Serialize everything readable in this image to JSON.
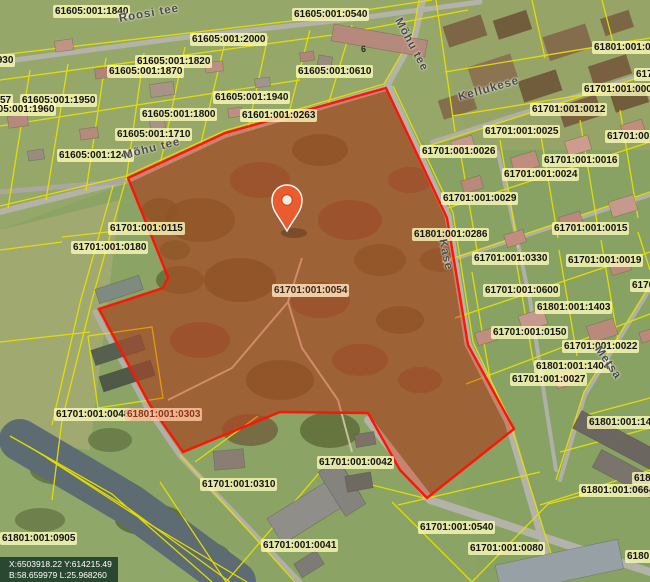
{
  "map": {
    "selected_parcel_code": "61701:001:0054",
    "building_number": "6",
    "coordinates_box": {
      "line1": "X:6503918.22 Y:614215.49",
      "line2": "B:58.659979 L:25.968260"
    },
    "colors": {
      "cadastral_line": "#e6e000",
      "parcel_outline": "#ff1405",
      "parcel_fill": "rgba(228,60,25,0.40)",
      "pin": "#ea5b2d",
      "label_bg": "rgba(255,252,185,0.78)"
    },
    "parcel_labels": [
      {
        "text": "61605:001:1840",
        "x": 53,
        "y": 5
      },
      {
        "text": "61605:001:0540",
        "x": 292,
        "y": 8
      },
      {
        "text": "61605:001:1930",
        "x": -62,
        "y": 54
      },
      {
        "text": "61605:001:2000",
        "x": 190,
        "y": 33
      },
      {
        "text": "61605:001:1820",
        "x": 135,
        "y": 55
      },
      {
        "text": "61605:001:1870",
        "x": 107,
        "y": 65
      },
      {
        "text": "61605:001:0610",
        "x": 296,
        "y": 65
      },
      {
        "text": "57",
        "x": -2,
        "y": 94
      },
      {
        "text": "61605:001:1950",
        "x": 20,
        "y": 94
      },
      {
        "text": "61605:001:1960",
        "x": -21,
        "y": 103
      },
      {
        "text": "61605:001:1800",
        "x": 140,
        "y": 108
      },
      {
        "text": "61605:001:1940",
        "x": 213,
        "y": 91
      },
      {
        "text": "61601:001:0263",
        "x": 240,
        "y": 109
      },
      {
        "text": "61605:001:1710",
        "x": 115,
        "y": 128
      },
      {
        "text": "61605:001:1240",
        "x": 57,
        "y": 149
      },
      {
        "text": "61701:001:0115",
        "x": 108,
        "y": 222
      },
      {
        "text": "61701:001:0180",
        "x": 71,
        "y": 241
      },
      {
        "text": "61701:001:0054",
        "x": 272,
        "y": 284,
        "variant": "highlight"
      },
      {
        "text": "61701:001:0048",
        "x": 54,
        "y": 408
      },
      {
        "text": "61801:001:0303",
        "x": 125,
        "y": 408,
        "variant": "redtext"
      },
      {
        "text": "61701:001:0310",
        "x": 200,
        "y": 478
      },
      {
        "text": "61701:001:0042",
        "x": 317,
        "y": 456
      },
      {
        "text": "61701:001:0041",
        "x": 261,
        "y": 539
      },
      {
        "text": "61801:001:0905",
        "x": 0,
        "y": 532
      },
      {
        "text": "61701:001:0540",
        "x": 418,
        "y": 521
      },
      {
        "text": "61701:001:0080",
        "x": 468,
        "y": 542
      },
      {
        "text": "61801:001:0664",
        "x": 579,
        "y": 484
      },
      {
        "text": "6180",
        "x": 632,
        "y": 472
      },
      {
        "text": "61801:001:142",
        "x": 587,
        "y": 416
      },
      {
        "text": "6180",
        "x": 625,
        "y": 550
      },
      {
        "text": "61701:001:",
        "x": 605,
        "y": 130
      },
      {
        "text": "61701:001:0025",
        "x": 483,
        "y": 125
      },
      {
        "text": "61701:001:0012",
        "x": 530,
        "y": 103
      },
      {
        "text": "61701:001:000",
        "x": 582,
        "y": 83
      },
      {
        "text": "617",
        "x": 634,
        "y": 68
      },
      {
        "text": "61801:001:0",
        "x": 592,
        "y": 41
      },
      {
        "text": "61701:001:0026",
        "x": 420,
        "y": 145
      },
      {
        "text": "61701:001:0016",
        "x": 542,
        "y": 154
      },
      {
        "text": "61701:001:0024",
        "x": 502,
        "y": 168
      },
      {
        "text": "61701:001:0029",
        "x": 441,
        "y": 192
      },
      {
        "text": "61801:001:0286",
        "x": 412,
        "y": 228
      },
      {
        "text": "61701:001:0015",
        "x": 552,
        "y": 222
      },
      {
        "text": "61701:001:0330",
        "x": 472,
        "y": 252
      },
      {
        "text": "61701:001:0019",
        "x": 566,
        "y": 254
      },
      {
        "text": "61701:001:0600",
        "x": 483,
        "y": 284
      },
      {
        "text": "61801:001:1403",
        "x": 535,
        "y": 301
      },
      {
        "text": "61701:001:0150",
        "x": 491,
        "y": 326
      },
      {
        "text": "61701:001:0022",
        "x": 562,
        "y": 340
      },
      {
        "text": "61801:001:1404",
        "x": 534,
        "y": 360
      },
      {
        "text": "61701:001:0027",
        "x": 510,
        "y": 373
      },
      {
        "text": "6170",
        "x": 630,
        "y": 279
      }
    ],
    "street_labels": [
      {
        "text": "Roosi tee",
        "x": 118,
        "y": 13,
        "rot": -10
      },
      {
        "text": "Mõhu tee",
        "x": 403,
        "y": 16,
        "rot": 62
      },
      {
        "text": "Mõhu tee",
        "x": 122,
        "y": 150,
        "rot": -14
      },
      {
        "text": "Kellukese",
        "x": 457,
        "y": 92,
        "rot": -16
      },
      {
        "text": "Kase",
        "x": 448,
        "y": 238,
        "rot": 78
      },
      {
        "text": "Metsa",
        "x": 602,
        "y": 344,
        "rot": 55
      }
    ]
  }
}
